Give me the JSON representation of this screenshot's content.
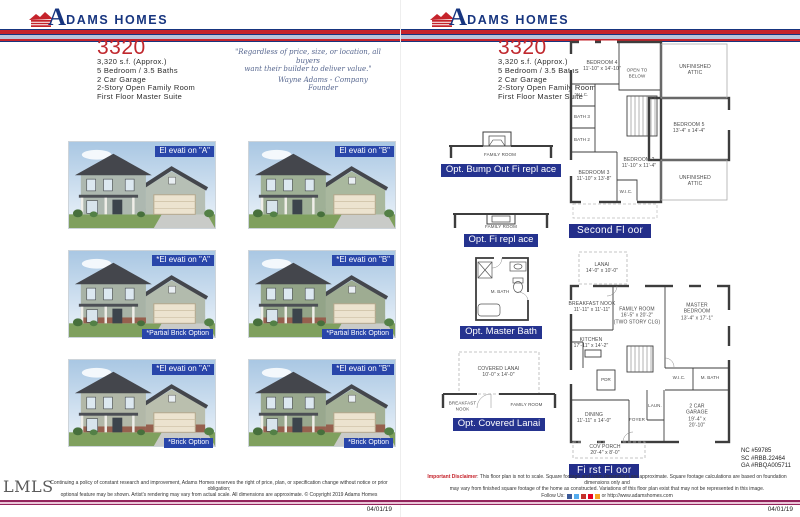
{
  "brand": {
    "a": "A",
    "rest": "DAMS HOMES"
  },
  "model_info": {
    "model": "3320",
    "specs": [
      "3,320 s.f. (Approx.)",
      "5 Bedroom / 3.5 Baths",
      "2 Car Garage",
      "2-Story Open Family Room",
      "First Floor Master Suite"
    ]
  },
  "quote": {
    "line1": "\"Regardless of price, size, or location, all buyers",
    "line2": "want their builder to deliver value.\"",
    "attribution": "Wayne Adams - Company Founder"
  },
  "elevations": [
    {
      "label": "El evati on \"A\""
    },
    {
      "label": "El evati on \"B\""
    },
    {
      "label": "*El evati on \"A\"",
      "option": "*Partial Brick Option"
    },
    {
      "label": "*El evati on \"B\"",
      "option": "*Partial Brick Option"
    },
    {
      "label": "*El evati on \"A\"",
      "option": "*Brick Option"
    },
    {
      "label": "*El evati on \"B\"",
      "option": "*Brick Option"
    }
  ],
  "options": {
    "bump_out_fireplace": {
      "caption": "Opt. Bump Out Fi repl ace",
      "room": "FAMILY ROOM"
    },
    "fireplace": {
      "caption": "Opt. Fi repl ace",
      "room": "FAMILY ROOM"
    },
    "master_bath": {
      "caption": "Opt. Master Bath",
      "room": "M. BATH"
    },
    "covered_lanai": {
      "caption": "Opt. Covered Lanai",
      "room": "COVERED LANAI\n10'-0\" x 14'-0\"",
      "room2": "BREAKFAST\nNOOK",
      "room3": "FAMILY ROOM"
    }
  },
  "second_floor": {
    "caption": "Second Fl oor",
    "rooms": {
      "bedroom4": "BEDROOM 4\n11'-10\" x 14'-10\"",
      "open_below": "OPEN TO\nBELOW",
      "attic_top": "UNFINISHED ATTIC",
      "wic1": "W.I.C.",
      "bath3": "BATH 3",
      "bath2": "BATH 2",
      "bedroom5": "BEDROOM 5\n13'-4\" x 14'-4\"",
      "bedroom2": "BEDROOM 2\n11'-10\" x 11'-4\"",
      "bedroom3": "BEDROOM 3\n11'-10\" x 13'-8\"",
      "wic2": "W.I.C.",
      "attic_bottom": "UNFINISHED ATTIC"
    }
  },
  "first_floor": {
    "caption": "Fi rst Fl oor",
    "rooms": {
      "lanai": "LANAI\n14'-0\" x 10'-0\"",
      "breakfast": "BREAKFAST NOOK\n11'-11\" x 11'-11\"",
      "family": "FAMILY ROOM\n16'-5\" x 20'-2\"\n(TWO STORY CLG)",
      "master": "MASTER BEDROOM\n13'-4\" x 17'-1\"",
      "kitchen": "KITCHEN\n17'-11\" x 14'-2\"",
      "pdr": "PDR",
      "wic": "W.I.C.",
      "mbath": "M. BATH",
      "dining": "DINING\n11'-11\" x 14'-0\"",
      "foyer": "FOYER",
      "laundry": "LAUN.",
      "garage": "2 CAR GARAGE\n19'-4\" x 20'-10\"",
      "porch": "COV PORCH\n20'-4\" x 8'-0\""
    }
  },
  "licenses": [
    "NC #59785",
    "SC #RBB.22464",
    "GA #RBQA005711"
  ],
  "footer_left": {
    "logo": "LMLS",
    "line1": "Continuing a policy of constant research and improvement, Adams Homes reserves the right of price, plan, or specification change without notice or prior obligation;",
    "line2": "optional feature may be shown. Artist's rendering may vary from actual scale. All dimensions are approximate.  © Copyright 2019 Adams Homes",
    "date": "04/01/19"
  },
  "footer_right": {
    "bold": "Important Disclaimer",
    "line1": ": This floor plan is not to scale. Square footage and room dimensions are approximate. Square footage calculations are based on foundation dimensions only and",
    "line2": "may vary from finished square footage of the home as constructed. Variations of this floor plan exist that may not be represented in this image.",
    "follow": "Follow Us:",
    "website": "or http://www.adamshomes.com",
    "date": "04/01/19"
  }
}
